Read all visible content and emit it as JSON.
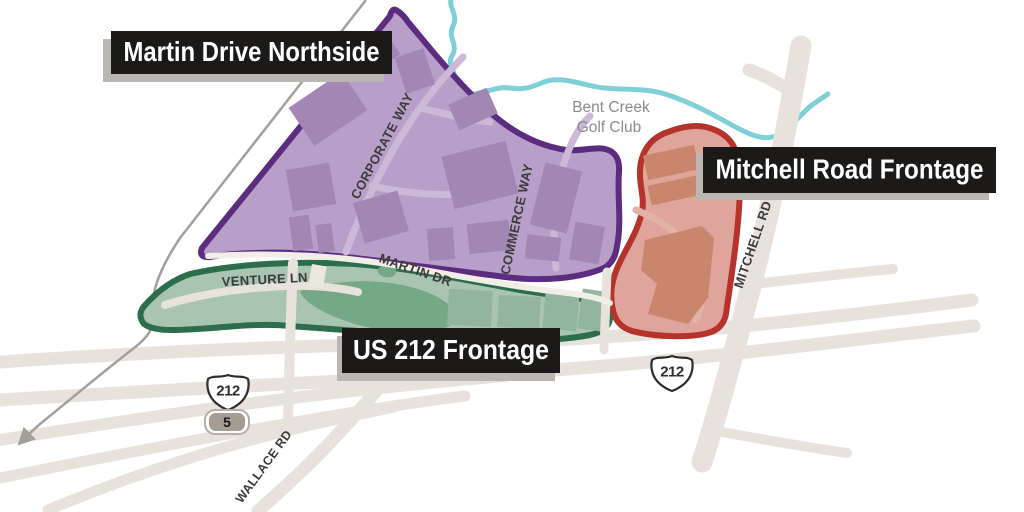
{
  "map": {
    "region_labels": {
      "martin": "Martin Drive Northside",
      "mitchell": "Mitchell Road Frontage",
      "us212": "US 212 Frontage"
    },
    "street_labels": {
      "corporate_way": "CORPORATE WAY",
      "commerce_way": "COMMERCE WAY",
      "martin_dr": "MARTIN DR",
      "venture_ln": "VENTURE LN",
      "mitchell_rd": "MITCHELL RD",
      "wallace_rd": "WALLACE RD"
    },
    "poi_labels": {
      "golf_club_line1": "Bent Creek",
      "golf_club_line2": "Golf Club"
    },
    "highway_shields": {
      "us212_west": "212",
      "us212_east": "212",
      "state_5": "5"
    },
    "colors": {
      "purple_fill": "#b89fc9",
      "purple_border": "#5c2c80",
      "purple_building": "#a287b4",
      "green_fill": "#a9c4b1",
      "green_border": "#2c6e4b",
      "green_building": "#93b59e",
      "green_pond": "#74a886",
      "red_fill": "#dfa49b",
      "red_border": "#b5332b",
      "red_building": "#c9866c",
      "creek": "#7fd0d6",
      "road": "#e7e3dc",
      "railline": "#a3a09c",
      "label_box_bg": "#1b1a19",
      "label_box_text": "#ffffff",
      "label_box_shadow": "#bab7b3",
      "street_label_text": "#3c3a3a",
      "poi_label_text": "#8d8a8a"
    }
  }
}
